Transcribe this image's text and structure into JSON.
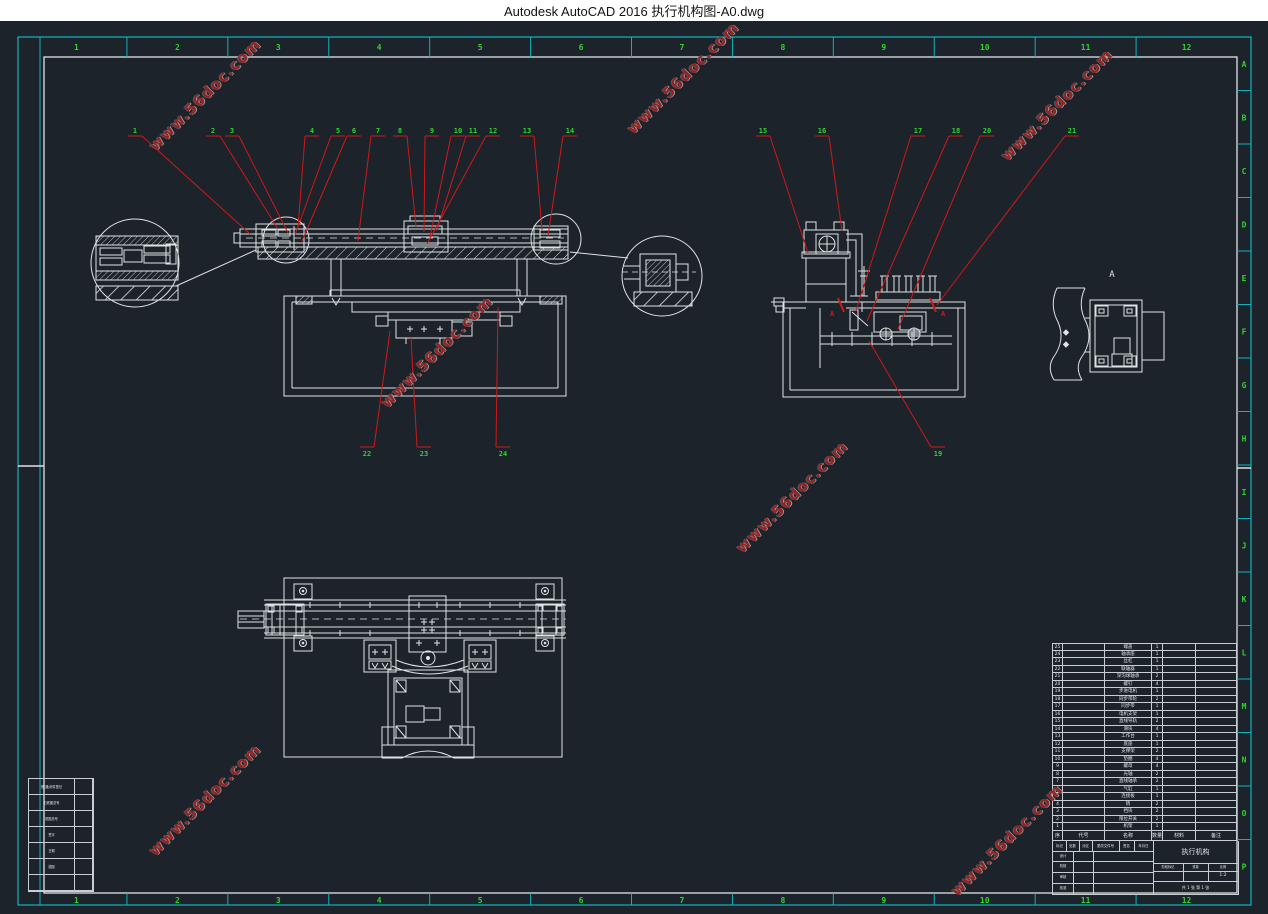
{
  "window": {
    "title": "Autodesk AutoCAD 2016    执行机构图-A0.dwg"
  },
  "colors": {
    "canvas": "#1d232b",
    "line": "#dfe3e6",
    "cyan": "#10b3bd",
    "green": "#2ed42e",
    "red": "#d01818",
    "watermark": "#9a2424",
    "titlebar_bg": "#ffffff",
    "titlebar_text": "#141414"
  },
  "border": {
    "top_labels": [
      "1",
      "2",
      "3",
      "4",
      "5",
      "6",
      "7",
      "8",
      "9",
      "10",
      "11",
      "12"
    ],
    "bottom_labels": [
      "1",
      "2",
      "3",
      "4",
      "5",
      "6",
      "7",
      "8",
      "9",
      "10",
      "11",
      "12"
    ],
    "right_labels": [
      "A",
      "B",
      "C",
      "D",
      "E",
      "F",
      "G",
      "H",
      "I",
      "J",
      "K",
      "L",
      "M",
      "N",
      "O",
      "P"
    ]
  },
  "section": {
    "label": "A",
    "cut_labels": [
      "A",
      "A"
    ]
  },
  "watermark": {
    "text": "www.56doc.com",
    "positions": [
      {
        "x": 205,
        "y": 95
      },
      {
        "x": 683,
        "y": 78
      },
      {
        "x": 1057,
        "y": 105
      },
      {
        "x": 437,
        "y": 352
      },
      {
        "x": 792,
        "y": 497
      },
      {
        "x": 205,
        "y": 800
      },
      {
        "x": 1007,
        "y": 840
      }
    ]
  },
  "callouts": {
    "front_top": [
      {
        "n": "1",
        "lx": 135,
        "tx": 250,
        "ty": 234
      },
      {
        "n": "2",
        "lx": 213,
        "tx": 278,
        "ty": 229
      },
      {
        "n": "3",
        "lx": 232,
        "tx": 288,
        "ty": 233
      },
      {
        "n": "4",
        "lx": 312,
        "tx": 298,
        "ty": 228
      },
      {
        "n": "5",
        "lx": 338,
        "tx": 295,
        "ty": 235
      },
      {
        "n": "6",
        "lx": 354,
        "tx": 302,
        "ty": 241
      },
      {
        "n": "7",
        "lx": 378,
        "tx": 358,
        "ty": 241
      },
      {
        "n": "8",
        "lx": 400,
        "tx": 416,
        "ty": 227
      },
      {
        "n": "9",
        "lx": 432,
        "tx": 424,
        "ty": 232
      },
      {
        "n": "10",
        "lx": 458,
        "tx": 430,
        "ty": 237
      },
      {
        "n": "11",
        "lx": 473,
        "tx": 437,
        "ty": 230
      },
      {
        "n": "12",
        "lx": 493,
        "tx": 427,
        "ty": 244
      },
      {
        "n": "13",
        "lx": 527,
        "tx": 542,
        "ty": 230
      },
      {
        "n": "14",
        "lx": 570,
        "tx": 548,
        "ty": 236
      }
    ],
    "front_bottom": [
      {
        "n": "22",
        "lx": 367,
        "tx": 390,
        "ty": 331
      },
      {
        "n": "23",
        "lx": 424,
        "tx": 411,
        "ty": 338
      },
      {
        "n": "24",
        "lx": 503,
        "tx": 498,
        "ty": 307
      }
    ],
    "side_top": [
      {
        "n": "15",
        "lx": 763,
        "tx": 808,
        "ty": 253
      },
      {
        "n": "16",
        "lx": 822,
        "tx": 842,
        "ty": 231
      },
      {
        "n": "17",
        "lx": 918,
        "tx": 856,
        "ty": 311
      },
      {
        "n": "18",
        "lx": 956,
        "tx": 867,
        "ty": 321
      },
      {
        "n": "20",
        "lx": 987,
        "tx": 898,
        "ty": 329
      },
      {
        "n": "21",
        "lx": 1072,
        "tx": 937,
        "ty": 305
      }
    ],
    "side_bottom": [
      {
        "n": "19",
        "lx": 938,
        "tx": 869,
        "ty": 341
      }
    ]
  },
  "bom": {
    "headers": [
      "序号",
      "代号",
      "名称",
      "数量",
      "材料",
      "备注"
    ],
    "rows": [
      [
        "25",
        "",
        "端盖",
        "1",
        "",
        ""
      ],
      [
        "24",
        "",
        "轴承座",
        "1",
        "",
        ""
      ],
      [
        "23",
        "",
        "丝杠",
        "1",
        "",
        ""
      ],
      [
        "22",
        "",
        "联轴器",
        "1",
        "",
        ""
      ],
      [
        "21",
        "",
        "深沟球轴承",
        "2",
        "",
        ""
      ],
      [
        "20",
        "",
        "螺钉",
        "4",
        "",
        ""
      ],
      [
        "19",
        "",
        "步进电机",
        "1",
        "",
        ""
      ],
      [
        "18",
        "",
        "同步带轮",
        "2",
        "",
        ""
      ],
      [
        "17",
        "",
        "同步带",
        "1",
        "",
        ""
      ],
      [
        "16",
        "",
        "电机支架",
        "1",
        "",
        ""
      ],
      [
        "15",
        "",
        "直线导轨",
        "2",
        "",
        ""
      ],
      [
        "14",
        "",
        "滑块",
        "4",
        "",
        ""
      ],
      [
        "13",
        "",
        "工作台",
        "1",
        "",
        ""
      ],
      [
        "12",
        "",
        "底座",
        "1",
        "",
        ""
      ],
      [
        "11",
        "",
        "支撑架",
        "2",
        "",
        ""
      ],
      [
        "10",
        "",
        "垫圈",
        "4",
        "",
        ""
      ],
      [
        "9",
        "",
        "螺母",
        "4",
        "",
        ""
      ],
      [
        "8",
        "",
        "光轴",
        "2",
        "",
        ""
      ],
      [
        "7",
        "",
        "直线轴承",
        "2",
        "",
        ""
      ],
      [
        "6",
        "",
        "气缸",
        "1",
        "",
        ""
      ],
      [
        "5",
        "",
        "连接板",
        "1",
        "",
        ""
      ],
      [
        "4",
        "",
        "销",
        "2",
        "",
        ""
      ],
      [
        "3",
        "",
        "挡块",
        "2",
        "",
        ""
      ],
      [
        "2",
        "",
        "限位开关",
        "2",
        "",
        ""
      ],
      [
        "1",
        "",
        "机架",
        "1",
        "",
        ""
      ]
    ]
  },
  "title_block": {
    "row1": [
      "标记",
      "处数",
      "分区",
      "更改文件号",
      "签名",
      "年月日"
    ],
    "left_rows": [
      "设计",
      "校核",
      "审核",
      "批准"
    ],
    "stage": "阶段标记",
    "weight": "重量",
    "scale": "比例",
    "scale_value": "1:2",
    "sheets": "共 1 张  第 1 张",
    "title": "执行机构"
  },
  "side_table": {
    "rows": [
      "借(通)用件登记",
      "旧底图总号",
      "底图总号",
      "签字",
      "日期",
      "描图",
      ""
    ]
  }
}
